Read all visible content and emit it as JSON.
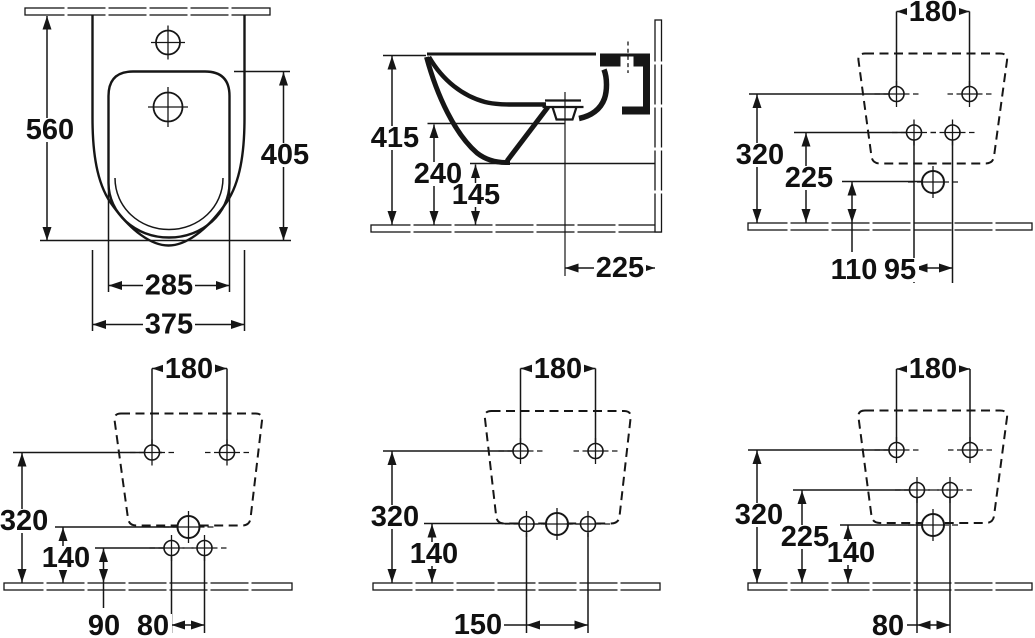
{
  "drawing": {
    "subject": "Wall-hung bidet technical dimension drawing, six views",
    "units": "mm",
    "line_color": "#161616",
    "background_color": "#ffffff"
  },
  "panels": [
    {
      "id": "front-plan-view",
      "dims": [
        {
          "name": "overall-depth",
          "value": "560"
        },
        {
          "name": "inner-basin-depth",
          "value": "405"
        },
        {
          "name": "inner-basin-width",
          "value": "285"
        },
        {
          "name": "overall-width",
          "value": "375"
        }
      ]
    },
    {
      "id": "side-section-view",
      "dims": [
        {
          "name": "overall-height",
          "value": "415"
        },
        {
          "name": "outlet-underside-height",
          "value": "240"
        },
        {
          "name": "body-underside-height",
          "value": "145"
        },
        {
          "name": "drain-offset-from-wall",
          "value": "225"
        }
      ]
    },
    {
      "id": "wall-fixing-view-1",
      "dims": [
        {
          "name": "fixing-hole-spacing",
          "value": "180"
        },
        {
          "name": "fixing-hole-height",
          "value": "320"
        },
        {
          "name": "supply-hole-height",
          "value": "225"
        },
        {
          "name": "outlet-height",
          "value": "110"
        },
        {
          "name": "supply-hole-spacing",
          "value": "95"
        }
      ]
    },
    {
      "id": "wall-fixing-view-2",
      "dims": [
        {
          "name": "fixing-hole-spacing",
          "value": "180"
        },
        {
          "name": "fixing-hole-height",
          "value": "320"
        },
        {
          "name": "outlet-height",
          "value": "140"
        },
        {
          "name": "lower-hole-height",
          "value": "90"
        },
        {
          "name": "lower-hole-spacing",
          "value": "80"
        }
      ]
    },
    {
      "id": "wall-fixing-view-3",
      "dims": [
        {
          "name": "fixing-hole-spacing",
          "value": "180"
        },
        {
          "name": "fixing-hole-height",
          "value": "320"
        },
        {
          "name": "outlet-height",
          "value": "140"
        },
        {
          "name": "lower-hole-spacing",
          "value": "150"
        }
      ]
    },
    {
      "id": "wall-fixing-view-4",
      "dims": [
        {
          "name": "fixing-hole-spacing",
          "value": "180"
        },
        {
          "name": "fixing-hole-height",
          "value": "320"
        },
        {
          "name": "supply-hole-height",
          "value": "225"
        },
        {
          "name": "outlet-height",
          "value": "140"
        },
        {
          "name": "supply-hole-spacing",
          "value": "80"
        }
      ]
    }
  ]
}
